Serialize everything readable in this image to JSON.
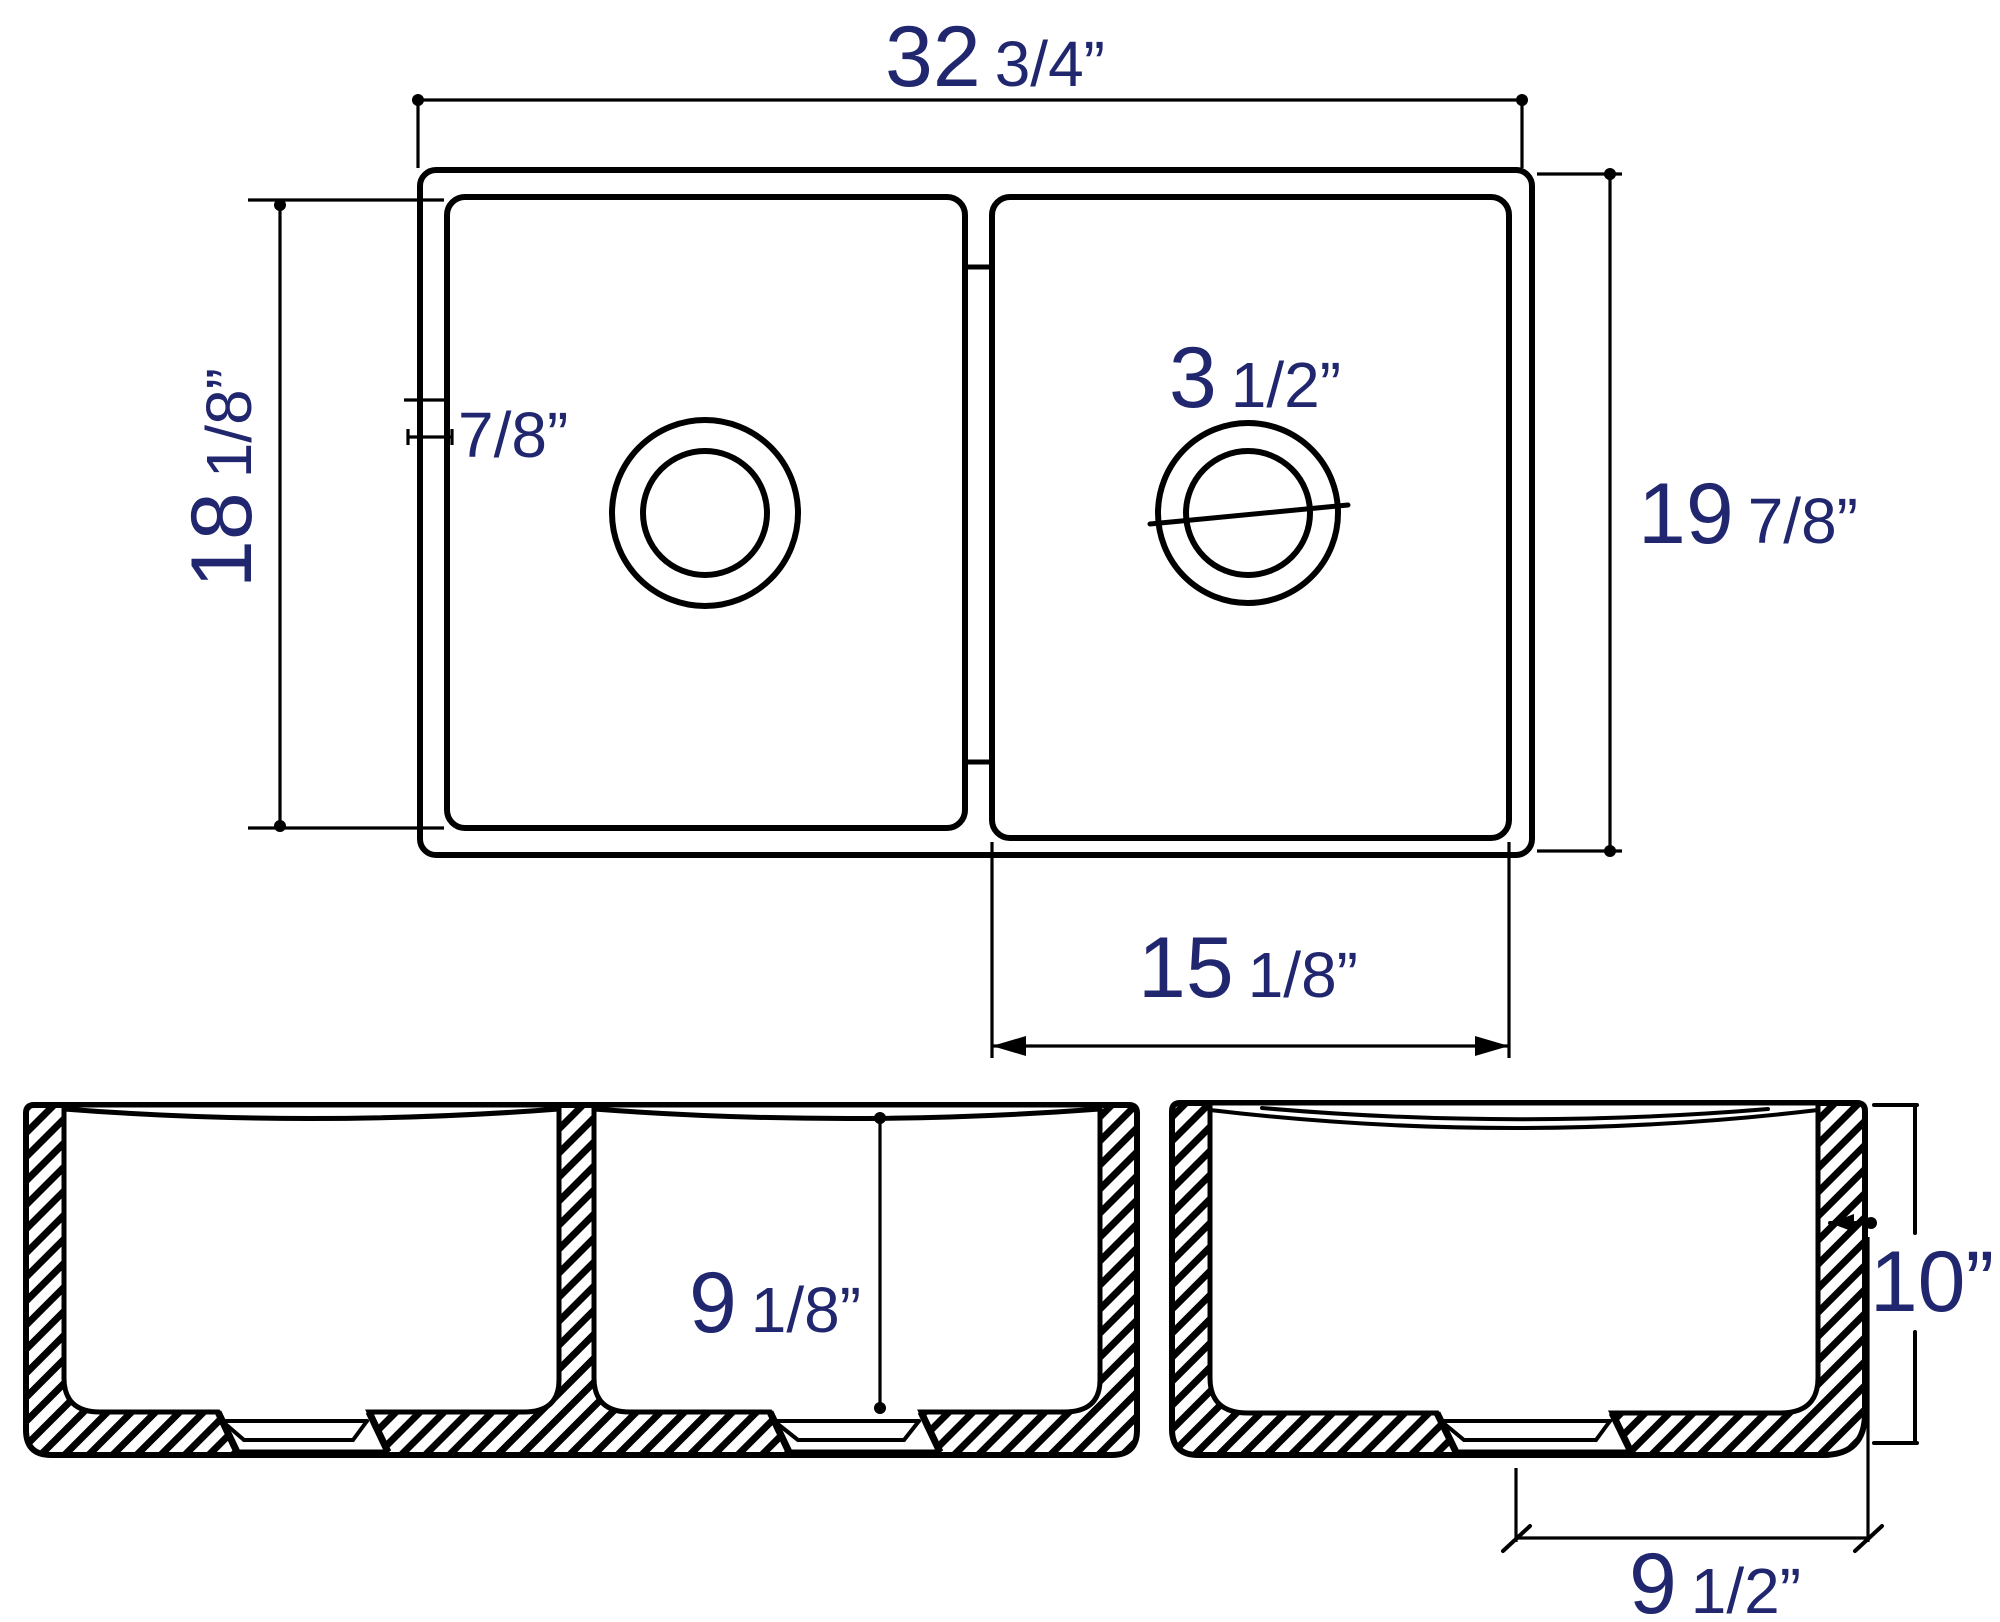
{
  "drawing": {
    "type": "technical-dimension-drawing",
    "subject": "double bowl farmhouse kitchen sink",
    "background": "#ffffff",
    "line_color": "#000000",
    "dimension_text_color": "#21276e"
  },
  "top_view": {
    "overall_width": {
      "big": "32",
      "small": "3/4”"
    },
    "left_bowl_length": {
      "big": "18",
      "small": "1/8”"
    },
    "rim_width": {
      "small": "7/8”"
    },
    "drain_diameter": {
      "big": "3",
      "small": "1/2”"
    },
    "overall_depth": {
      "big": "19",
      "small": "7/8”"
    },
    "right_bowl_width": {
      "big": "15",
      "small": "1/8”"
    }
  },
  "front_view": {
    "bowl_depth": {
      "big": "9",
      "small": "1/8”"
    }
  },
  "side_view": {
    "overall_height": {
      "big": "10”"
    },
    "base_flat_width": {
      "big": "9",
      "small": "1/2”"
    }
  }
}
